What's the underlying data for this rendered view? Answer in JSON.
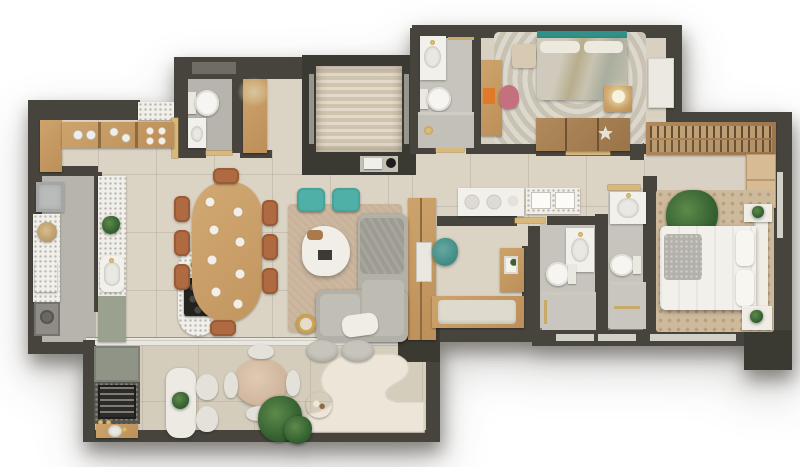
{
  "meta": {
    "image_kind": "apartment floor plan - rendered top-down view",
    "visible_text": "none"
  },
  "palette": {
    "wall": "#46443c",
    "wallDark": "#3b3a32",
    "floorMain": "#dbd3c3",
    "floorBalcony": "#d5cdbc",
    "floorGray": "#b7b4ad",
    "floorGrayLight": "#c7c4bd",
    "travertine": "#d9cdb9",
    "wood": "#cda36c",
    "terrazzo": "#f0efea",
    "teal": "#4fb0a7",
    "terracotta": "#b06a42",
    "sofa": "#b2b0a7",
    "rugLiving": "#c8b299",
    "rugMaster": "#cdb99c",
    "white": "#f2f0ea",
    "gold": "#c79d4e",
    "plantGreen": "#3a612f",
    "sage": "#9aa18f",
    "pink": "#c4707e",
    "orangeArt": "#e07a28",
    "background": "#ffffff"
  },
  "rooms": {
    "kitchen": {
      "label": "Kitchen",
      "furniture": [
        "upper shelf with dishes",
        "terrazzo counter with sink",
        "sage lower cabinet",
        "terrazzo island with cooktop and fruit bowl"
      ]
    },
    "dining": {
      "label": "Dining area",
      "furniture": [
        "organic wood dining table with 8 place settings",
        "8 terracotta wood chairs"
      ]
    },
    "living": {
      "label": "Living room",
      "furniture": [
        "L-shaped gray sofa",
        "white organic coffee table",
        "2 teal poufs",
        "beige rug",
        "gold side table",
        "wood TV panel"
      ]
    },
    "laundry": {
      "label": "Laundry room",
      "furniture": [
        "steel sink",
        "terrazzo counter",
        "round basket",
        "wicker cubbies",
        "washer"
      ]
    },
    "powder_room": {
      "label": "Powder room",
      "furniture": [
        "toilet",
        "small sink counter",
        "wall niche"
      ]
    },
    "entry": {
      "label": "Entry hall",
      "furniture": [
        "wood console with dried arrangement",
        "entry door"
      ]
    },
    "elevator": {
      "label": "Elevator shaft",
      "furniture": [
        "travertine cab floor",
        "glass doors",
        "intercom panel"
      ]
    },
    "hall_bathroom": {
      "label": "Hall bathroom",
      "furniture": [
        "white vanity with gold tap",
        "toilet",
        "shower with gold head",
        "towel bar"
      ]
    },
    "bedroom_2": {
      "label": "Bedroom 2",
      "furniture": [
        "bed with teal headboard",
        "beige bench",
        "desk with pink chair and orange artwork",
        "nightstand with lamp",
        "white wardrobe",
        "open closet shelf"
      ]
    },
    "walk_in_closet": {
      "label": "Walk-in closet",
      "furniture": [
        "hanging rail with clothes",
        "drawer dresser"
      ]
    },
    "master_bedroom": {
      "label": "Master bedroom",
      "furniture": [
        "white double bed",
        "gray throw",
        "two nightstands",
        "large plant",
        "patterned rug"
      ]
    },
    "bathroom_a": {
      "label": "Bathroom A",
      "furniture": [
        "white counter with basin",
        "toilet",
        "shower with towel bar"
      ]
    },
    "bathroom_b": {
      "label": "Bathroom B",
      "furniture": [
        "white counter with basin",
        "toilet",
        "shower with towel bar"
      ]
    },
    "hallway": {
      "label": "Hallway",
      "furniture": [
        "white sideboard vanity",
        "terrazzo vanity with trays",
        "interior doors"
      ]
    },
    "office_nook": {
      "label": "Office nook",
      "furniture": [
        "wood desk",
        "teal desk chair",
        "wood shelf with frames",
        "bench with cushion"
      ]
    },
    "balcony": {
      "label": "Balcony terrace",
      "furniture": [
        "sliding glass door",
        "grill counter with sink",
        "sage cabinet",
        "white bar table with 2 chairs",
        "round table with 4 chairs",
        "curvy white rug",
        "2 round poufs",
        "wood tray table",
        "large potted plant"
      ]
    }
  }
}
